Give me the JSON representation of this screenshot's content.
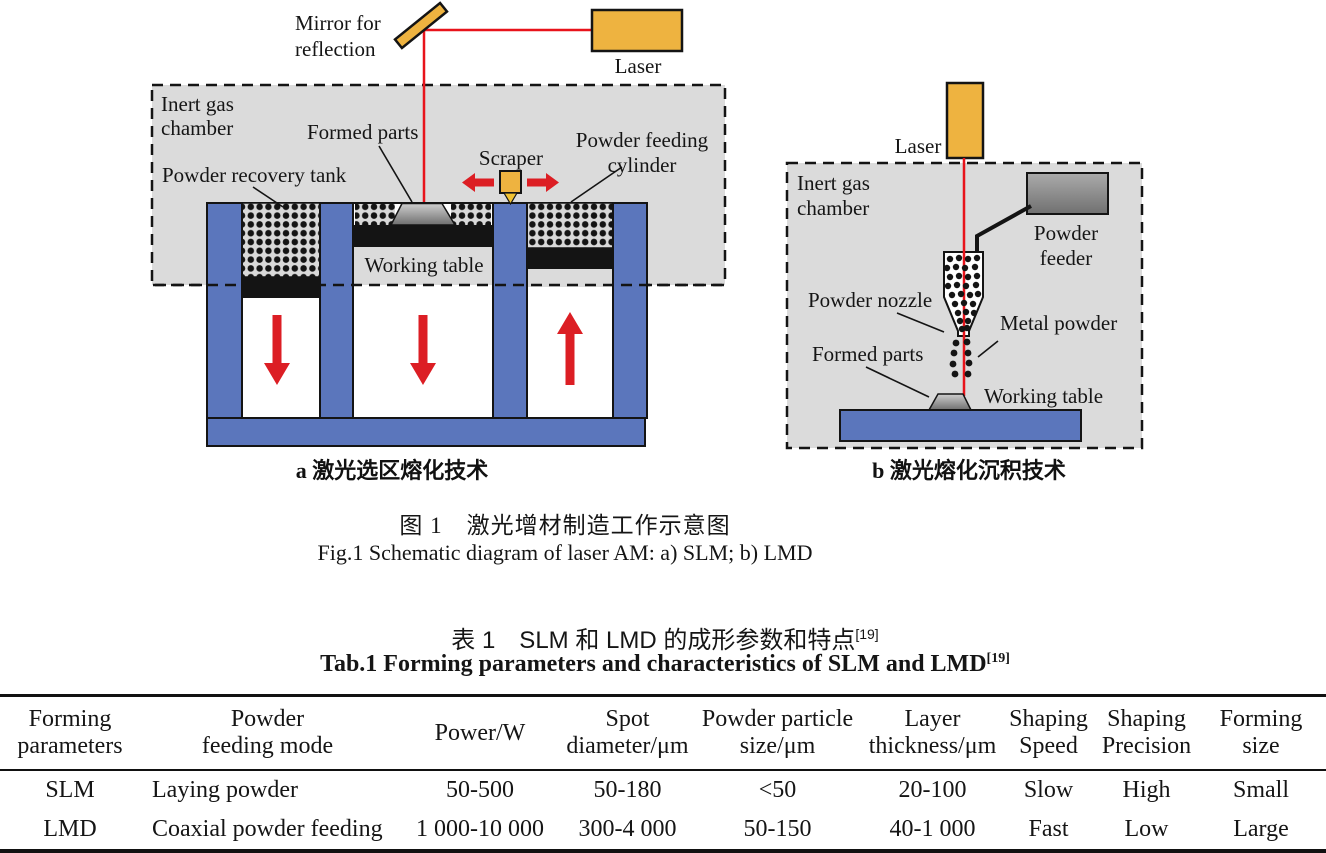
{
  "fig_a": {
    "mirror_l1": "Mirror for",
    "mirror_l2": "reflection",
    "laser": "Laser",
    "chamber_l1": "Inert gas",
    "chamber_l2": "chamber",
    "formed_parts": "Formed parts",
    "recovery_tank": "Powder recovery tank",
    "scraper": "Scraper",
    "feeding_cylinder_l1": "Powder feeding",
    "feeding_cylinder_l2": "cylinder",
    "working_table": "Working table",
    "caption": "a  激光选区熔化技术"
  },
  "fig_b": {
    "laser": "Laser",
    "chamber_l1": "Inert gas",
    "chamber_l2": "chamber",
    "powder_feeder_l1": "Powder",
    "powder_feeder_l2": "feeder",
    "powder_nozzle": "Powder nozzle",
    "metal_powder": "Metal powder",
    "formed_parts": "Formed parts",
    "working_table": "Working table",
    "caption": "b  激光熔化沉积技术"
  },
  "caption": {
    "zh": "图 1　激光增材制造工作示意图",
    "en": "Fig.1 Schematic diagram of laser AM: a) SLM; b) LMD"
  },
  "table": {
    "title_zh": "表 1　SLM 和 LMD 的成形参数和特点",
    "title_zh_ref": "[19]",
    "title_en": "Tab.1 Forming parameters and characteristics of SLM and LMD",
    "title_en_ref": "[19]",
    "columns": [
      {
        "l1": "Forming",
        "l2": "parameters"
      },
      {
        "l1": "Powder",
        "l2": "feeding mode"
      },
      {
        "l1": "Power/W",
        "l2": ""
      },
      {
        "l1": "Spot",
        "l2": "diameter/μm"
      },
      {
        "l1": "Powder particle",
        "l2": "size/μm"
      },
      {
        "l1": "Layer",
        "l2": "thickness/μm"
      },
      {
        "l1": "Shaping",
        "l2": "Speed"
      },
      {
        "l1": "Shaping",
        "l2": "Precision"
      },
      {
        "l1": "Forming",
        "l2": "size"
      }
    ],
    "rows": [
      {
        "cells": [
          "SLM",
          "Laying powder",
          "50-500",
          "50-180",
          "<50",
          "20-100",
          "Slow",
          "High",
          "Small"
        ]
      },
      {
        "cells": [
          "LMD",
          "Coaxial powder feeding",
          "1 000-10 000",
          "300-4 000",
          "50-150",
          "40-1 000",
          "Fast",
          "Low",
          "Large"
        ]
      }
    ]
  },
  "colors": {
    "laser_orange": "#EEB340",
    "scraper_tip_yellow": "#F1C232",
    "machine_blue": "#5B76BC",
    "chamber_gray": "#DBDBDB",
    "arrow_red": "#DC1E24",
    "beam_red": "#E8131B",
    "outline_black": "#141414"
  }
}
